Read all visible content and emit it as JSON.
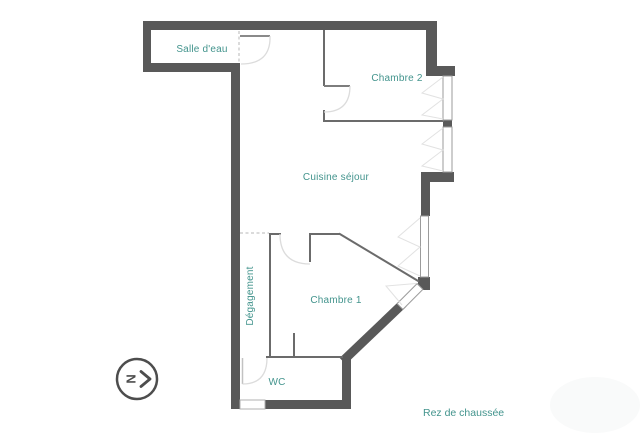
{
  "floor_label": "Rez de chaussée",
  "rooms": {
    "salle_deau": "Salle d'eau",
    "chambre2": "Chambre 2",
    "cuisine": "Cuisine séjour",
    "chambre1": "Chambre 1",
    "degagement": "Dégagement",
    "wc": "WC"
  },
  "compass": {
    "letter": "N",
    "direction": "right"
  },
  "colors": {
    "background": "#ffffff",
    "wall_exterior": "#595959",
    "wall_interior": "#6b6b6b",
    "door_arc": "#dcdcdc",
    "window_border": "#9b9b9b",
    "dashed_line": "#cfcfcf",
    "label_teal": "#43948d",
    "compass": "#4d4d4d"
  }
}
